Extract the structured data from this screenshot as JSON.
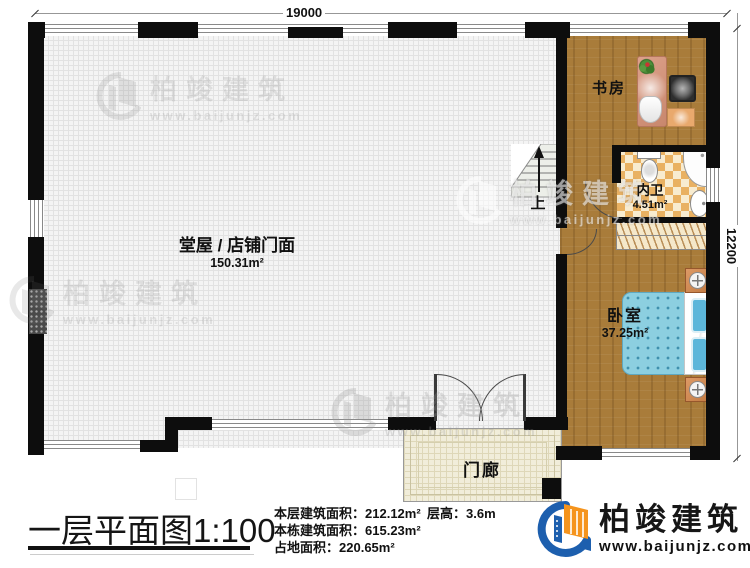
{
  "plan": {
    "dimensions": {
      "top": "19000",
      "right": "12200"
    },
    "rooms": {
      "hall": {
        "name": "堂屋 / 店铺门面",
        "area": "150.31m²"
      },
      "study": {
        "name": "书房"
      },
      "bathroom": {
        "name": "内卫",
        "area": "4.51m²"
      },
      "bedroom": {
        "name": "卧室",
        "area": "37.25m²"
      },
      "porch": {
        "name": "门廊"
      },
      "stairs": {
        "up_label": "上"
      }
    }
  },
  "titleblock": {
    "title": "一层平面图",
    "scale": "1:100",
    "stats": [
      {
        "label": "本层建筑面积：",
        "value": "212.12m²"
      },
      {
        "label": "本栋建筑面积：",
        "value": "615.23m²"
      },
      {
        "label": "占地面积：",
        "value": "220.65m²"
      }
    ],
    "floor_height_label": "层高：",
    "floor_height_value": "3.6m"
  },
  "branding": {
    "company": "柏竣建筑",
    "website": "www.baijunjz.com"
  },
  "watermark": {
    "company": "柏竣建筑",
    "website": "www.baijunjz.com"
  },
  "colors": {
    "wall": "#0d0d0d",
    "wood_floor": "#a97c3a",
    "bath_tile": "#e9b162",
    "bed": "#8ccfe0",
    "logo_blue": "#1d5fae",
    "logo_orange": "#f5941d"
  }
}
